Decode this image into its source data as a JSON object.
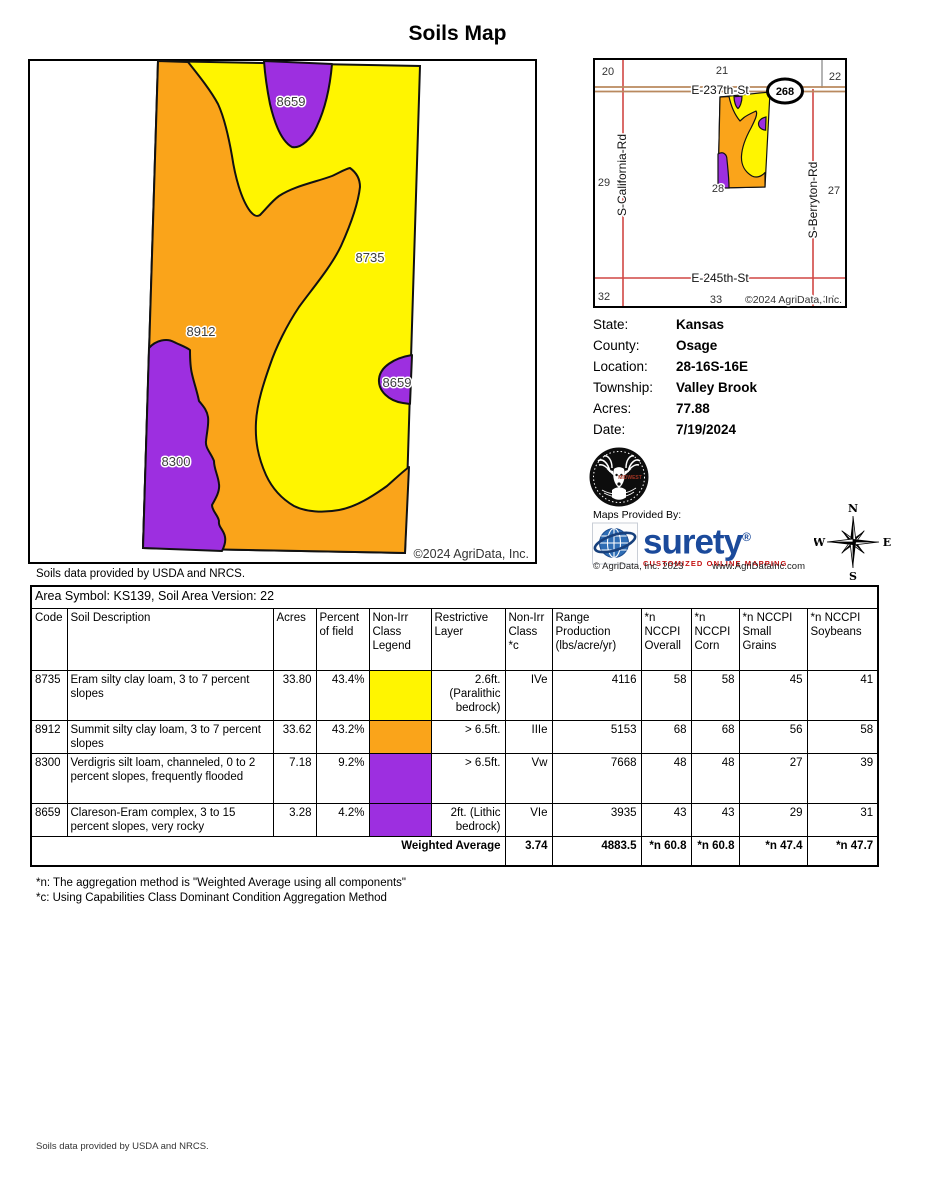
{
  "title": "Soils Map",
  "map": {
    "region_labels": [
      "8659",
      "8735",
      "8912",
      "8659",
      "8300"
    ],
    "attribution": "©2024 AgriData, Inc.",
    "source_note": "Soils data provided by USDA and NRCS.",
    "colors": {
      "yellow": "#FFF500",
      "orange": "#FAA41A",
      "purple": "#9D2FE0"
    }
  },
  "locator": {
    "sections": [
      "20",
      "21",
      "22",
      "29",
      "28",
      "27",
      "32",
      "33",
      "34"
    ],
    "roads": {
      "top": "E-237th-St",
      "bottom": "E-245th-St",
      "left": "S-California-Rd",
      "right": "S-Berryton-Rd"
    },
    "badge": "268",
    "attribution": "©2024 AgriData, Inc."
  },
  "info": {
    "rows": [
      {
        "label": "State:",
        "value": "Kansas"
      },
      {
        "label": "County:",
        "value": "Osage"
      },
      {
        "label": "Location:",
        "value": "28-16S-16E"
      },
      {
        "label": "Township:",
        "value": "Valley Brook"
      },
      {
        "label": "Acres:",
        "value": "77.88"
      },
      {
        "label": "Date:",
        "value": "7/19/2024"
      }
    ]
  },
  "branding": {
    "provided_by": "Maps Provided By:",
    "logo_word": "surety",
    "logo_reg": "®",
    "tagline": "CUSTOMIZED ONLINE MAPPING",
    "copyright": "© AgriData, Inc. 2023",
    "website": "www.AgriDataInc.com",
    "deer_text": "MIDWEST",
    "compass": {
      "n": "N",
      "e": "E",
      "s": "S",
      "w": "W"
    }
  },
  "table": {
    "area_symbol": "Area Symbol: KS139, Soil Area Version: 22",
    "columns": [
      "Code",
      "Soil Description",
      "Acres",
      "Percent of field",
      "Non-Irr Class Legend",
      "Restrictive Layer",
      "Non-Irr Class *c",
      "Range Production (lbs/acre/yr)",
      "*n NCCPI Overall",
      "*n NCCPI Corn",
      "*n NCCPI Small Grains",
      "*n NCCPI Soybeans"
    ],
    "rows": [
      {
        "code": "8735",
        "description": "Eram silty clay loam, 3 to 7 percent slopes",
        "acres": "33.80",
        "percent": "43.4%",
        "color": "#FFF500",
        "restrictive": "2.6ft. (Paralithic bedrock)",
        "class_c": "IVe",
        "production": "4116",
        "overall": "58",
        "corn": "58",
        "small_grains": "45",
        "soybeans": "41"
      },
      {
        "code": "8912",
        "description": "Summit silty clay loam, 3 to 7 percent slopes",
        "acres": "33.62",
        "percent": "43.2%",
        "color": "#FAA41A",
        "restrictive": "> 6.5ft.",
        "class_c": "IIIe",
        "production": "5153",
        "overall": "68",
        "corn": "68",
        "small_grains": "56",
        "soybeans": "58"
      },
      {
        "code": "8300",
        "description": "Verdigris silt loam, channeled, 0 to 2 percent slopes, frequently flooded",
        "acres": "7.18",
        "percent": "9.2%",
        "color": "#9D2FE0",
        "restrictive": "> 6.5ft.",
        "class_c": "Vw",
        "production": "7668",
        "overall": "48",
        "corn": "48",
        "small_grains": "27",
        "soybeans": "39"
      },
      {
        "code": "8659",
        "description": "Clareson-Eram complex, 3 to 15 percent slopes, very rocky",
        "acres": "3.28",
        "percent": "4.2%",
        "color": "#9D2FE0",
        "restrictive": "2ft. (Lithic bedrock)",
        "class_c": "VIe",
        "production": "3935",
        "overall": "43",
        "corn": "43",
        "small_grains": "29",
        "soybeans": "31"
      }
    ],
    "weighted": {
      "label": "Weighted Average",
      "class_c": "3.74",
      "production": "4883.5",
      "overall": "*n 60.8",
      "corn": "*n 60.8",
      "small_grains": "*n 47.4",
      "soybeans": "*n 47.7"
    }
  },
  "footnotes": [
    "*n: The aggregation method is \"Weighted Average using all components\"",
    "*c: Using Capabilities Class Dominant Condition Aggregation Method"
  ],
  "page_footer": "Soils data provided by USDA and NRCS."
}
